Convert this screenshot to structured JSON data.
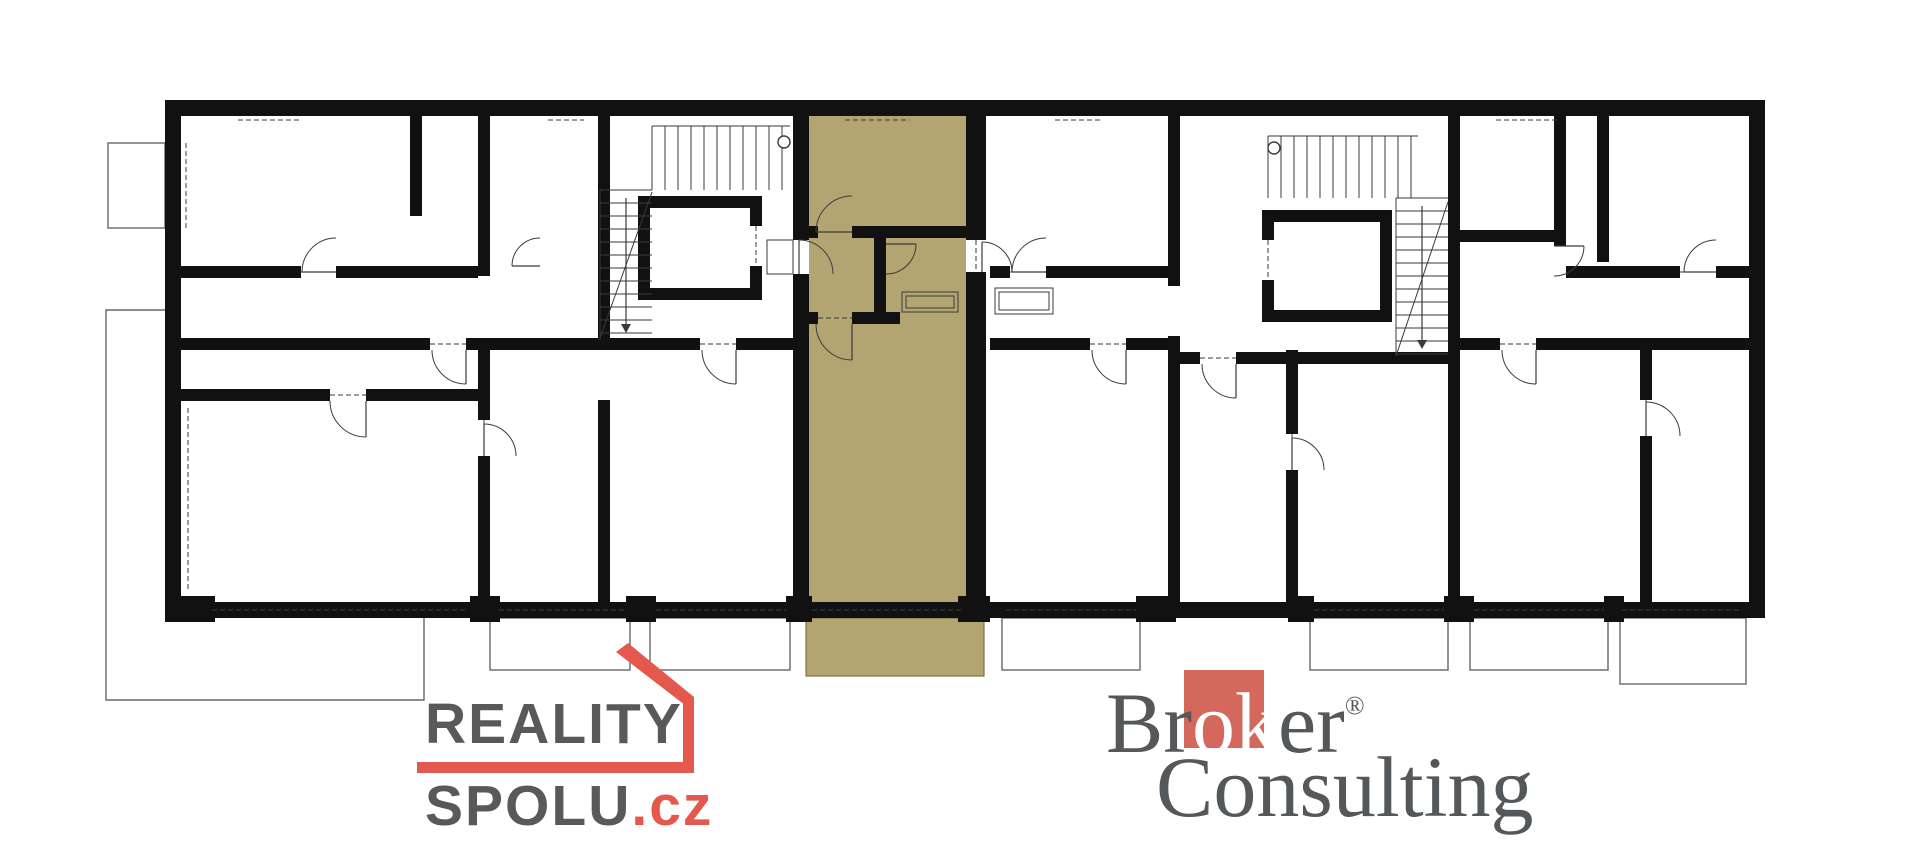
{
  "canvas": {
    "w": 1920,
    "h": 854,
    "bg": "#ffffff"
  },
  "colors": {
    "wall": "#111111",
    "line": "#3a3a3a",
    "thin": "#666666",
    "highlight": "#b3a572",
    "highlight_line": "#80713f",
    "logo_red": "#e4584d",
    "logo_gray": "#58595b",
    "broker_red": "#d4685c",
    "broker_gray": "#54585a"
  },
  "logos": {
    "reality": {
      "line1": "REALITY",
      "line2": "SPOLU",
      "tld": ".cz"
    },
    "broker": {
      "part1": "Br",
      "part2": "ok",
      "part3": "er",
      "reg": "®",
      "line2": "Consulting"
    }
  },
  "plan": {
    "walls": [
      [
        165,
        100,
        1600,
        16
      ],
      [
        165,
        602,
        1600,
        16
      ],
      [
        165,
        100,
        16,
        518
      ],
      [
        1749,
        100,
        16,
        518
      ],
      [
        793,
        116,
        16,
        124
      ],
      [
        793,
        274,
        16,
        328
      ],
      [
        966,
        116,
        20,
        124
      ],
      [
        966,
        272,
        20,
        330
      ],
      [
        809,
        226,
        9,
        12
      ],
      [
        852,
        226,
        114,
        12
      ],
      [
        809,
        312,
        9,
        12
      ],
      [
        852,
        312,
        48,
        12
      ],
      [
        874,
        238,
        12,
        74
      ],
      [
        478,
        116,
        12,
        160
      ],
      [
        478,
        340,
        12,
        80
      ],
      [
        478,
        456,
        12,
        146
      ],
      [
        598,
        116,
        12,
        234
      ],
      [
        598,
        400,
        12,
        202
      ],
      [
        410,
        116,
        12,
        100
      ],
      [
        181,
        266,
        120,
        12
      ],
      [
        336,
        266,
        142,
        12
      ],
      [
        181,
        338,
        249,
        12
      ],
      [
        466,
        338,
        132,
        12
      ],
      [
        610,
        338,
        90,
        12
      ],
      [
        736,
        338,
        57,
        12
      ],
      [
        181,
        389,
        149,
        12
      ],
      [
        366,
        389,
        112,
        12
      ],
      [
        638,
        196,
        124,
        12
      ],
      [
        638,
        288,
        124,
        12
      ],
      [
        638,
        196,
        12,
        104
      ],
      [
        750,
        196,
        12,
        30
      ],
      [
        750,
        266,
        12,
        34
      ],
      [
        1168,
        116,
        12,
        170
      ],
      [
        1168,
        336,
        12,
        266
      ],
      [
        990,
        266,
        20,
        12
      ],
      [
        1046,
        266,
        122,
        12
      ],
      [
        990,
        338,
        100,
        12
      ],
      [
        1126,
        338,
        42,
        12
      ],
      [
        1448,
        116,
        12,
        486
      ],
      [
        1180,
        352,
        20,
        12
      ],
      [
        1236,
        352,
        212,
        12
      ],
      [
        1262,
        210,
        130,
        12
      ],
      [
        1262,
        310,
        130,
        12
      ],
      [
        1262,
        210,
        12,
        30
      ],
      [
        1262,
        280,
        12,
        42
      ],
      [
        1380,
        210,
        12,
        112
      ],
      [
        1554,
        116,
        12,
        130
      ],
      [
        1460,
        230,
        94,
        12
      ],
      [
        1566,
        266,
        114,
        12
      ],
      [
        1716,
        266,
        33,
        12
      ],
      [
        1460,
        338,
        40,
        12
      ],
      [
        1536,
        338,
        213,
        12
      ],
      [
        1640,
        350,
        12,
        50
      ],
      [
        1640,
        436,
        12,
        166
      ],
      [
        1286,
        350,
        12,
        84
      ],
      [
        1286,
        470,
        12,
        132
      ],
      [
        1597,
        116,
        12,
        146
      ],
      [
        165,
        596,
        50,
        26
      ],
      [
        470,
        596,
        30,
        26
      ],
      [
        626,
        596,
        30,
        26
      ],
      [
        786,
        596,
        26,
        26
      ],
      [
        958,
        596,
        32,
        26
      ],
      [
        1136,
        596,
        40,
        26
      ],
      [
        1288,
        596,
        26,
        26
      ],
      [
        1444,
        596,
        30,
        26
      ],
      [
        1604,
        596,
        20,
        26
      ]
    ],
    "windows": [
      [
        238,
        100,
        64,
        16,
        "h",
        0
      ],
      [
        352,
        100,
        28,
        16,
        "h",
        0
      ],
      [
        548,
        100,
        36,
        16,
        "h",
        0
      ],
      [
        845,
        100,
        65,
        16,
        "h",
        1
      ],
      [
        1055,
        100,
        46,
        16,
        "h",
        0
      ],
      [
        1496,
        100,
        64,
        16,
        "h",
        0
      ],
      [
        1672,
        100,
        40,
        16,
        "h",
        0
      ],
      [
        210,
        602,
        260,
        16,
        "h",
        0
      ],
      [
        497,
        602,
        129,
        16,
        "h",
        0
      ],
      [
        654,
        602,
        134,
        16,
        "h",
        0
      ],
      [
        810,
        602,
        153,
        16,
        "h",
        1
      ],
      [
        1004,
        602,
        134,
        16,
        "h",
        0
      ],
      [
        1312,
        602,
        134,
        16,
        "h",
        0
      ],
      [
        1472,
        602,
        134,
        16,
        "h",
        0
      ],
      [
        1622,
        602,
        122,
        16,
        "h",
        0
      ],
      [
        165,
        143,
        16,
        85,
        "v",
        0
      ],
      [
        165,
        408,
        16,
        182,
        "v",
        0
      ],
      [
        1749,
        165,
        16,
        63,
        "v",
        0
      ]
    ],
    "balconies": [
      [
        490,
        618,
        140,
        52
      ],
      [
        650,
        618,
        140,
        52
      ],
      [
        1002,
        618,
        138,
        52
      ],
      [
        1310,
        618,
        138,
        52
      ],
      [
        1470,
        618,
        138,
        52
      ],
      [
        1620,
        618,
        126,
        66
      ],
      [
        108,
        143,
        57,
        85
      ]
    ],
    "highlight_unit": {
      "room": [
        809,
        116,
        157,
        486
      ],
      "balcony": [
        806,
        618,
        178,
        58
      ]
    },
    "terrace_path": "M165,310 L106,310 L106,700 L424,700 L424,618",
    "stairs": [
      [
        652,
        126,
        138,
        64,
        "h",
        13
      ],
      [
        600,
        190,
        52,
        150,
        "v",
        13
      ],
      [
        1268,
        136,
        150,
        62,
        "h",
        13
      ],
      [
        1396,
        198,
        52,
        158,
        "v",
        13
      ]
    ],
    "diagonals": [
      [
        652,
        192,
        600,
        338
      ],
      [
        1396,
        356,
        1448,
        202
      ]
    ],
    "arrows": [
      [
        626,
        198,
        626,
        324
      ],
      [
        1422,
        206,
        1422,
        340
      ]
    ],
    "circles": [
      [
        784,
        142,
        6
      ],
      [
        1274,
        148,
        6
      ]
    ],
    "closets": [
      [
        995,
        288,
        58,
        26
      ],
      [
        999,
        292,
        50,
        18
      ],
      [
        902,
        292,
        56,
        20
      ],
      [
        906,
        296,
        48,
        12
      ]
    ],
    "dashed": [
      [
        818,
        232,
        852,
        232
      ],
      [
        799,
        240,
        799,
        274
      ],
      [
        818,
        318,
        852,
        318
      ],
      [
        976,
        240,
        976,
        272
      ],
      [
        301,
        272,
        336,
        272
      ],
      [
        430,
        344,
        466,
        344
      ],
      [
        700,
        344,
        736,
        344
      ],
      [
        330,
        395,
        366,
        395
      ],
      [
        1010,
        272,
        1046,
        272
      ],
      [
        1090,
        344,
        1126,
        344
      ],
      [
        1200,
        358,
        1236,
        358
      ],
      [
        1500,
        344,
        1536,
        344
      ],
      [
        1680,
        272,
        1716,
        272
      ],
      [
        484,
        420,
        484,
        456
      ],
      [
        1646,
        400,
        1646,
        436
      ],
      [
        1292,
        434,
        1292,
        470
      ],
      [
        212,
        610,
        468,
        610
      ],
      [
        499,
        610,
        624,
        610
      ],
      [
        656,
        610,
        786,
        610
      ],
      [
        812,
        610,
        961,
        610
      ],
      [
        1006,
        610,
        1136,
        610
      ],
      [
        1314,
        610,
        1444,
        610
      ],
      [
        1474,
        610,
        1604,
        610
      ],
      [
        1622,
        610,
        1743,
        610
      ],
      [
        238,
        120,
        302,
        120
      ],
      [
        548,
        120,
        584,
        120
      ],
      [
        845,
        120,
        910,
        120
      ],
      [
        1055,
        120,
        1101,
        120
      ],
      [
        1496,
        120,
        1560,
        120
      ],
      [
        186,
        143,
        186,
        228
      ],
      [
        188,
        408,
        188,
        590
      ],
      [
        756,
        226,
        756,
        266
      ],
      [
        1268,
        240,
        1268,
        280
      ]
    ],
    "dash_rects": [
      [
        767,
        240,
        26,
        34
      ]
    ],
    "doors": [
      [
        852,
        232,
        36,
        180
      ],
      [
        799,
        274,
        34,
        270
      ],
      [
        886,
        244,
        30,
        0
      ],
      [
        852,
        324,
        36,
        90
      ],
      [
        982,
        272,
        30,
        270
      ],
      [
        336,
        272,
        34,
        180
      ],
      [
        466,
        350,
        34,
        90
      ],
      [
        736,
        350,
        34,
        90
      ],
      [
        540,
        266,
        28,
        180
      ],
      [
        366,
        401,
        36,
        90
      ],
      [
        1046,
        272,
        34,
        180
      ],
      [
        1126,
        350,
        34,
        90
      ],
      [
        1236,
        364,
        34,
        90
      ],
      [
        1536,
        350,
        34,
        90
      ],
      [
        1716,
        272,
        32,
        180
      ],
      [
        1554,
        246,
        30,
        0
      ],
      [
        1646,
        436,
        34,
        270
      ],
      [
        1292,
        470,
        32,
        270
      ],
      [
        484,
        456,
        32,
        270
      ]
    ],
    "logo_shapes": {
      "bar": [
        417,
        762,
        277,
        11
      ],
      "vert": [
        683,
        700,
        11,
        68
      ],
      "roof": "M616,652 L628,643 L694,697 L694,712 Z"
    }
  }
}
